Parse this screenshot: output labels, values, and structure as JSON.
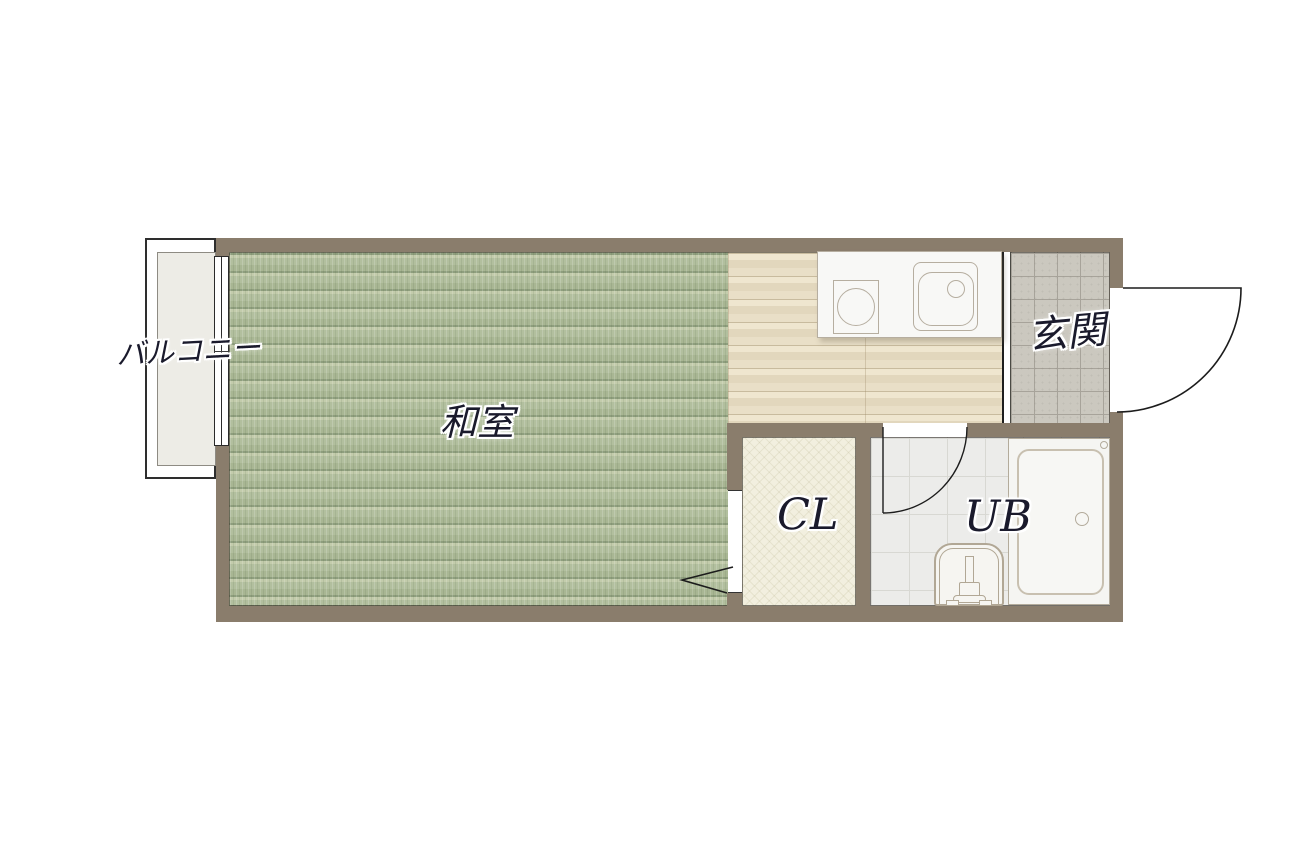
{
  "plan": {
    "labels": {
      "balcony": "バルコニー",
      "tatami_room": "和室",
      "entrance": "玄関",
      "closet": "CL",
      "unit_bath": "UB"
    },
    "colors": {
      "wall": "#8a7d6c",
      "tatami_floor": "#aeb99a",
      "kitchen_wood_floor": "#e8dec6",
      "entrance_tile": "#cbc8bf",
      "bath_tile": "#ececea",
      "closet_floor": "#f2efdf",
      "balcony_floor": "#edece6",
      "label_ink": "#1a1a2c",
      "fixture_line": "#b6aea0",
      "door_line": "#1c1c1c"
    }
  }
}
